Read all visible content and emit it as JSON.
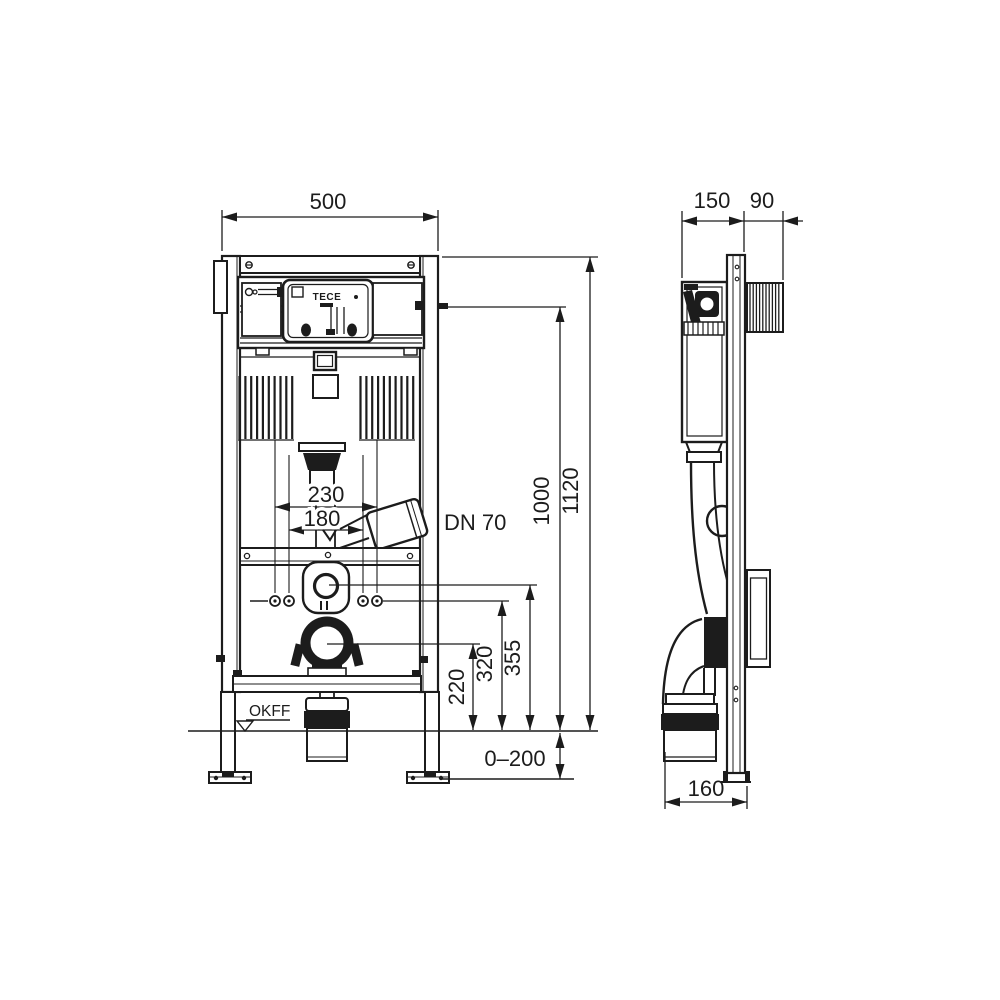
{
  "meta": {
    "background": "#ffffff",
    "line_color": "#1c1c1c"
  },
  "labels": {
    "brand_logo": "TECE",
    "floor_level": "OKFF",
    "drain_pipe": "DN 70"
  },
  "dimensions": {
    "frame_width": "500",
    "frame_depth": "150",
    "bracket_depth": "90",
    "upper_height": "1000",
    "total_height": "1120",
    "fixing_spacing_outer": "230",
    "fixing_spacing_inner": "180",
    "drain_axis_height": "220",
    "rod_exit_height": "320",
    "flush_outlet_height": "355",
    "foot_adjust_range": "0–200",
    "outlet_offset": "160"
  }
}
